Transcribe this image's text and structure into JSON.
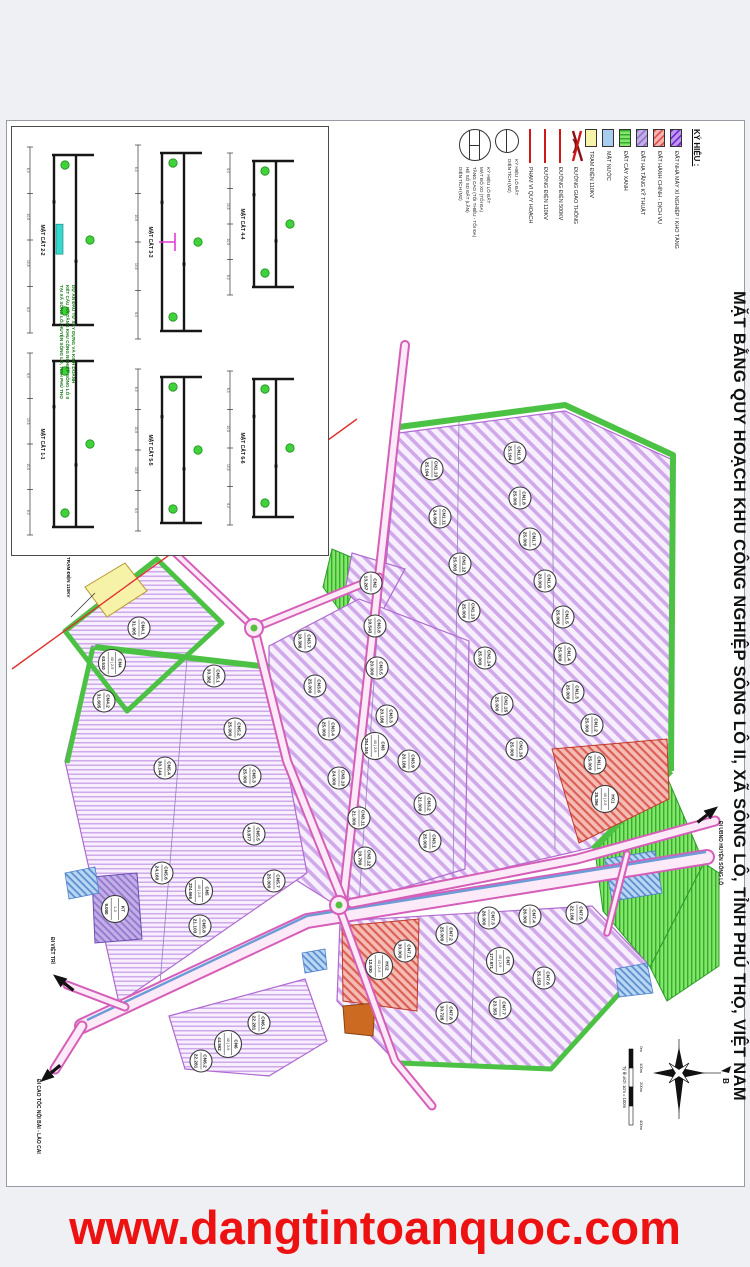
{
  "banner": {
    "url_text": "www.dangtintoanquoc.com"
  },
  "title": "MẶT BẰNG QUY HOẠCH KHU CÔNG NGHIỆP SÔNG LÔ II, XÃ SÔNG LÔ, TỈNH PHÚ THỌ, VIỆT NAM",
  "legend": {
    "heading": "KÝ HIỆU :",
    "swatches": [
      {
        "style": "fac",
        "label": "ĐẤT NHÀ MÁY XÍ NGHIỆP / KHO TÀNG"
      },
      {
        "style": "hc",
        "label": "ĐẤT HÀNH CHÍNH - DỊCH VỤ"
      },
      {
        "style": "ht",
        "label": "ĐẤT HẠ TẦNG KỸ THUẬT"
      },
      {
        "style": "cx",
        "label": "ĐẤT CÂY XANH"
      },
      {
        "style": "mn",
        "label": "MẶT NƯỚC"
      },
      {
        "style": "td",
        "label": "TRẠM ĐIỆN 110KV"
      }
    ],
    "lines": [
      {
        "style": "road",
        "label": "ĐƯỜNG GIAO THÔNG"
      },
      {
        "style": "red",
        "label": "ĐƯỜNG ĐIỆN 500KV"
      },
      {
        "style": "red",
        "label": "ĐƯỜNG ĐIỆN 110KV"
      },
      {
        "style": "red",
        "label": "PHẠM VI QUY HOẠCH"
      }
    ],
    "symbol_simple": {
      "labels": [
        "KÝ HIỆU LÔ ĐẤT",
        "DIỆN TÍCH (M2)"
      ]
    },
    "symbol_full": {
      "labels": [
        "KÝ HIỆU LÔ ĐẤT",
        "MẬT ĐỘ XD (TỐI ĐA)",
        "TẦNG CAO (TỐI THIỂU - TỐI ĐA)",
        "HỆ SỐ SD ĐẤT (LẦN)",
        "DIỆN TÍCH (M2)"
      ]
    }
  },
  "sections": {
    "items": [
      {
        "name": "MẶT CẮT 2-2",
        "x": 12,
        "y": 14,
        "w": 102,
        "h": 198,
        "water": true
      },
      {
        "name": "MẶT CẮT 1-1",
        "x": 12,
        "y": 220,
        "w": 102,
        "h": 194
      },
      {
        "name": "MẶT CẮT 3-3",
        "x": 120,
        "y": 12,
        "w": 86,
        "h": 206,
        "median": true
      },
      {
        "name": "MẶT CẮT 5-5",
        "x": 120,
        "y": 236,
        "w": 86,
        "h": 174
      },
      {
        "name": "MẶT CẮT 4-4",
        "x": 212,
        "y": 20,
        "w": 94,
        "h": 154
      },
      {
        "name": "MẶT CẮT 6-6",
        "x": 212,
        "y": 238,
        "w": 94,
        "h": 166
      }
    ],
    "dims": [
      "6,0",
      "10,5",
      "10,5",
      "6,0"
    ]
  },
  "notes": {
    "lines": [
      "DỰ ÁN ĐẦU TƯ XÂY DỰNG VÀ KINH DOANH",
      "KẾT CẤU HẠ TẦNG KHU CÔNG NGHIỆP SÔNG LÔ II",
      "TẠI XÃ SÔNG LÔ, HUYỆN SÔNG LÔ, TỈNH PHÚ THỌ"
    ]
  },
  "compass": {
    "north_label": "B",
    "x": 672,
    "y": 952
  },
  "scalebar": {
    "caption": "Tỷ lệ xích 1cm = 100m",
    "ticks": [
      "0m",
      "100m",
      "200m",
      "400m"
    ],
    "x": 624,
    "y": 928,
    "len": 76
  },
  "map": {
    "clusters": [
      {
        "id": "CN1",
        "pattern": "diag",
        "points": "392,312 558,290 668,340 664,652 588,726 345,782"
      },
      {
        "id": "CN2",
        "pattern": "diag",
        "points": "345,432 398,448 370,500 338,470"
      },
      {
        "id": "CN3",
        "pattern": "diag",
        "points": "262,525 352,478 462,520 458,748 332,786 262,742"
      },
      {
        "id": "CN7",
        "pattern": "diag",
        "points": "333,800 585,785 640,842 545,948 390,942 330,880"
      },
      {
        "id": "CN4",
        "pattern": "horiz",
        "points": "58,510 150,438 215,502 120,590"
      },
      {
        "id": "CN5",
        "pattern": "horiz",
        "points": "85,525 262,548 300,752 112,882 58,640"
      },
      {
        "id": "CN6",
        "pattern": "horiz",
        "points": "162,895 298,858 320,920 262,955 178,948"
      }
    ],
    "greens": [
      "325,428 358,442 336,494 316,466",
      "588,730 660,656 697,742 643,846 596,790",
      "643,846 697,742 712,752 712,845 660,880"
    ],
    "green_paths": [
      {
        "d": "M392,306 L558,284 L666,334 L664,650",
        "w": 6
      },
      {
        "d": "M664,650 L586,728",
        "w": 6
      },
      {
        "d": "M88,526 L262,546",
        "w": 6
      },
      {
        "d": "M60,642 L86,526",
        "w": 5
      },
      {
        "d": "M392,942 L544,948 L638,844",
        "w": 5
      },
      {
        "d": "M58,510 L150,438 L215,502 L120,590 Z",
        "w": 5
      }
    ],
    "specials": [
      {
        "type": "yellow",
        "points": "78,466 118,442 140,470 100,496"
      },
      {
        "type": "red",
        "points": "545,628 660,618 662,678 572,722"
      },
      {
        "type": "red",
        "points": "335,805 412,798 410,890 336,880"
      },
      {
        "type": "orange",
        "points": "336,885 368,882 366,915 338,912"
      },
      {
        "type": "purple",
        "points": "85,756 130,752 135,818 88,822"
      }
    ],
    "ponds": [
      "598,738 648,730 655,772 605,780",
      "608,848 640,842 646,872 612,876",
      "58,752 88,746 92,772 62,778",
      "295,832 318,828 320,848 298,852"
    ],
    "roads": [
      {
        "pts": "708,700 570,738 345,782",
        "w": 7
      },
      {
        "pts": "336,780 388,312 398,224",
        "w": 6
      },
      {
        "pts": "247,507 280,640 336,780",
        "w": 6
      },
      {
        "pts": "247,507 372,456",
        "w": 5
      },
      {
        "pts": "247,507 168,432",
        "w": 4
      },
      {
        "pts": "332,786 388,940 425,985",
        "w": 5
      },
      {
        "pts": "620,733 600,812",
        "w": 3.5
      },
      {
        "pts": "118,886 60,864",
        "w": 5
      },
      {
        "pts": "75,905 48,948",
        "w": 7
      }
    ],
    "highway": {
      "pts": "75,905 300,800 700,736",
      "w": 12,
      "median": "80,899 300,795 699,731"
    },
    "redlines": [
      "5,548 350,298"
    ],
    "roundabouts": [
      [
        247,
        507
      ],
      [
        332,
        784
      ]
    ],
    "dividers": [
      "452,300 446,762",
      "545,292 548,728",
      "372,486 352,782",
      "468,790 464,944",
      "180,538 152,874"
    ],
    "arrows": [
      {
        "label": "ĐI VIỆT TRÌ",
        "x": 57,
        "y": 862,
        "angle": 218,
        "lx": 44,
        "ly": 816
      },
      {
        "label": "ĐI CAO TỐC NỘI BÀI - LÀO CAI",
        "x": 44,
        "y": 952,
        "angle": 140,
        "lx": 30,
        "ly": 958
      },
      {
        "label": "ĐI UBND HUYỆN SÔNG LÔ",
        "x": 700,
        "y": 694,
        "angle": 322,
        "lx": 712,
        "ly": 700
      }
    ],
    "station_label": {
      "label": "TRẠM ĐIỆN 110KV",
      "lx": 60,
      "ly": 436,
      "leader": "64,496 88,472"
    },
    "parcels": [
      {
        "id": "CN1.9",
        "area": "25.194",
        "x": 508,
        "y": 332
      },
      {
        "id": "CN1.8",
        "area": "25.000",
        "x": 513,
        "y": 377
      },
      {
        "id": "CN1.7",
        "area": "25.000",
        "x": 523,
        "y": 418
      },
      {
        "id": "CN1.6",
        "area": "20.000",
        "x": 538,
        "y": 460
      },
      {
        "id": "CN1.5",
        "area": "25.000",
        "x": 556,
        "y": 496
      },
      {
        "id": "CN1.4",
        "area": "25.000",
        "x": 558,
        "y": 533
      },
      {
        "id": "CN1.3",
        "area": "25.000",
        "x": 566,
        "y": 571
      },
      {
        "id": "CN1.2",
        "area": "25.000",
        "x": 585,
        "y": 604
      },
      {
        "id": "CN1.1",
        "area": "25.000",
        "x": 588,
        "y": 642
      },
      {
        "id": "CN1.10",
        "area": "25.194",
        "x": 425,
        "y": 348
      },
      {
        "id": "CN1.11",
        "area": "24.000",
        "x": 433,
        "y": 396
      },
      {
        "id": "CN1.12",
        "area": "25.003",
        "x": 453,
        "y": 443
      },
      {
        "id": "CN1.13",
        "area": "25.000",
        "x": 462,
        "y": 490
      },
      {
        "id": "CN1.14",
        "area": "25.000",
        "x": 478,
        "y": 537
      },
      {
        "id": "CN1.15",
        "area": "25.000",
        "x": 495,
        "y": 583
      },
      {
        "id": "CN1.16",
        "area": "25.000",
        "x": 510,
        "y": 628
      },
      {
        "segs": [
          "HC1",
          "40 | 2-9",
          "25.356"
        ],
        "x": 598,
        "y": 678
      },
      {
        "id": "CN2",
        "area": "13.267",
        "x": 364,
        "y": 462
      },
      {
        "id": "CN3.7",
        "area": "19.386",
        "x": 298,
        "y": 520
      },
      {
        "id": "CN3.8",
        "area": "19.543",
        "x": 368,
        "y": 505
      },
      {
        "id": "CN3.6",
        "area": "25.000",
        "x": 308,
        "y": 565
      },
      {
        "id": "CN3.5",
        "area": "20.000",
        "x": 370,
        "y": 547
      },
      {
        "id": "CN3.4",
        "area": "25.000",
        "x": 322,
        "y": 608
      },
      {
        "id": "CN3.3",
        "area": "20.186",
        "x": 380,
        "y": 595
      },
      {
        "segs": [
          "CN3",
          "40 | 2-9",
          "254.346"
        ],
        "x": 368,
        "y": 625
      },
      {
        "id": "CN3.10",
        "area": "24.000",
        "x": 332,
        "y": 657
      },
      {
        "id": "CN3.9",
        "area": "20.186",
        "x": 402,
        "y": 640
      },
      {
        "id": "CN3.11",
        "area": "21.000",
        "x": 352,
        "y": 697
      },
      {
        "id": "CN3.2",
        "area": "21.000",
        "x": 418,
        "y": 683
      },
      {
        "id": "CN3.12",
        "area": "19.790",
        "x": 358,
        "y": 737
      },
      {
        "id": "CN3.1",
        "area": "25.000",
        "x": 423,
        "y": 720
      },
      {
        "id": "CN7.1",
        "area": "30.000",
        "x": 398,
        "y": 830
      },
      {
        "id": "CN7.2",
        "area": "25.000",
        "x": 440,
        "y": 813
      },
      {
        "id": "CN7.3",
        "area": "26.000",
        "x": 482,
        "y": 797
      },
      {
        "id": "CN7.4",
        "area": "26.000",
        "x": 523,
        "y": 795
      },
      {
        "id": "CN7.5",
        "area": "22.186",
        "x": 570,
        "y": 792
      },
      {
        "segs": [
          "CN7",
          "40 | 2-9",
          "177.971"
        ],
        "x": 493,
        "y": 840
      },
      {
        "id": "CN7.6",
        "area": "25.153",
        "x": 537,
        "y": 857
      },
      {
        "id": "CN7.7",
        "area": "23.353",
        "x": 493,
        "y": 887
      },
      {
        "id": "CN7.8",
        "area": "30.726",
        "x": 440,
        "y": 892
      },
      {
        "segs": [
          "HC2",
          "40 | 2-9",
          "12.930"
        ],
        "x": 372,
        "y": 845
      },
      {
        "id": "CN4.1",
        "area": "31.905",
        "x": 132,
        "y": 507
      },
      {
        "segs": [
          "CN4",
          "40 | 2-9",
          "63.510"
        ],
        "x": 105,
        "y": 542
      },
      {
        "id": "CN4.2",
        "area": "31.605",
        "x": 97,
        "y": 580
      },
      {
        "id": "CN5.1",
        "area": "30.382",
        "x": 207,
        "y": 555
      },
      {
        "id": "CN5.2",
        "area": "25.000",
        "x": 228,
        "y": 608
      },
      {
        "id": "CN5.3",
        "area": "25.000",
        "x": 243,
        "y": 655
      },
      {
        "id": "CN5.4",
        "area": "30.144",
        "x": 158,
        "y": 647
      },
      {
        "id": "CN5.5",
        "area": "43.877",
        "x": 247,
        "y": 713
      },
      {
        "id": "CN5.6",
        "area": "24.160",
        "x": 155,
        "y": 752
      },
      {
        "segs": [
          "CN5",
          "40 | 2-9",
          "224.666"
        ],
        "x": 192,
        "y": 770
      },
      {
        "id": "CN5.7",
        "area": "25.000",
        "x": 267,
        "y": 760
      },
      {
        "id": "CN5.8",
        "area": "21.103",
        "x": 193,
        "y": 805
      },
      {
        "id": "CN6.1",
        "area": "22.281",
        "x": 252,
        "y": 902
      },
      {
        "segs": [
          "CN6",
          "40 | 2-9",
          "44.562"
        ],
        "x": 221,
        "y": 923
      },
      {
        "id": "CN6.2",
        "area": "22.281",
        "x": 194,
        "y": 940
      },
      {
        "segs": [
          "KT",
          "1-3",
          "9.000"
        ],
        "x": 108,
        "y": 788
      }
    ]
  }
}
